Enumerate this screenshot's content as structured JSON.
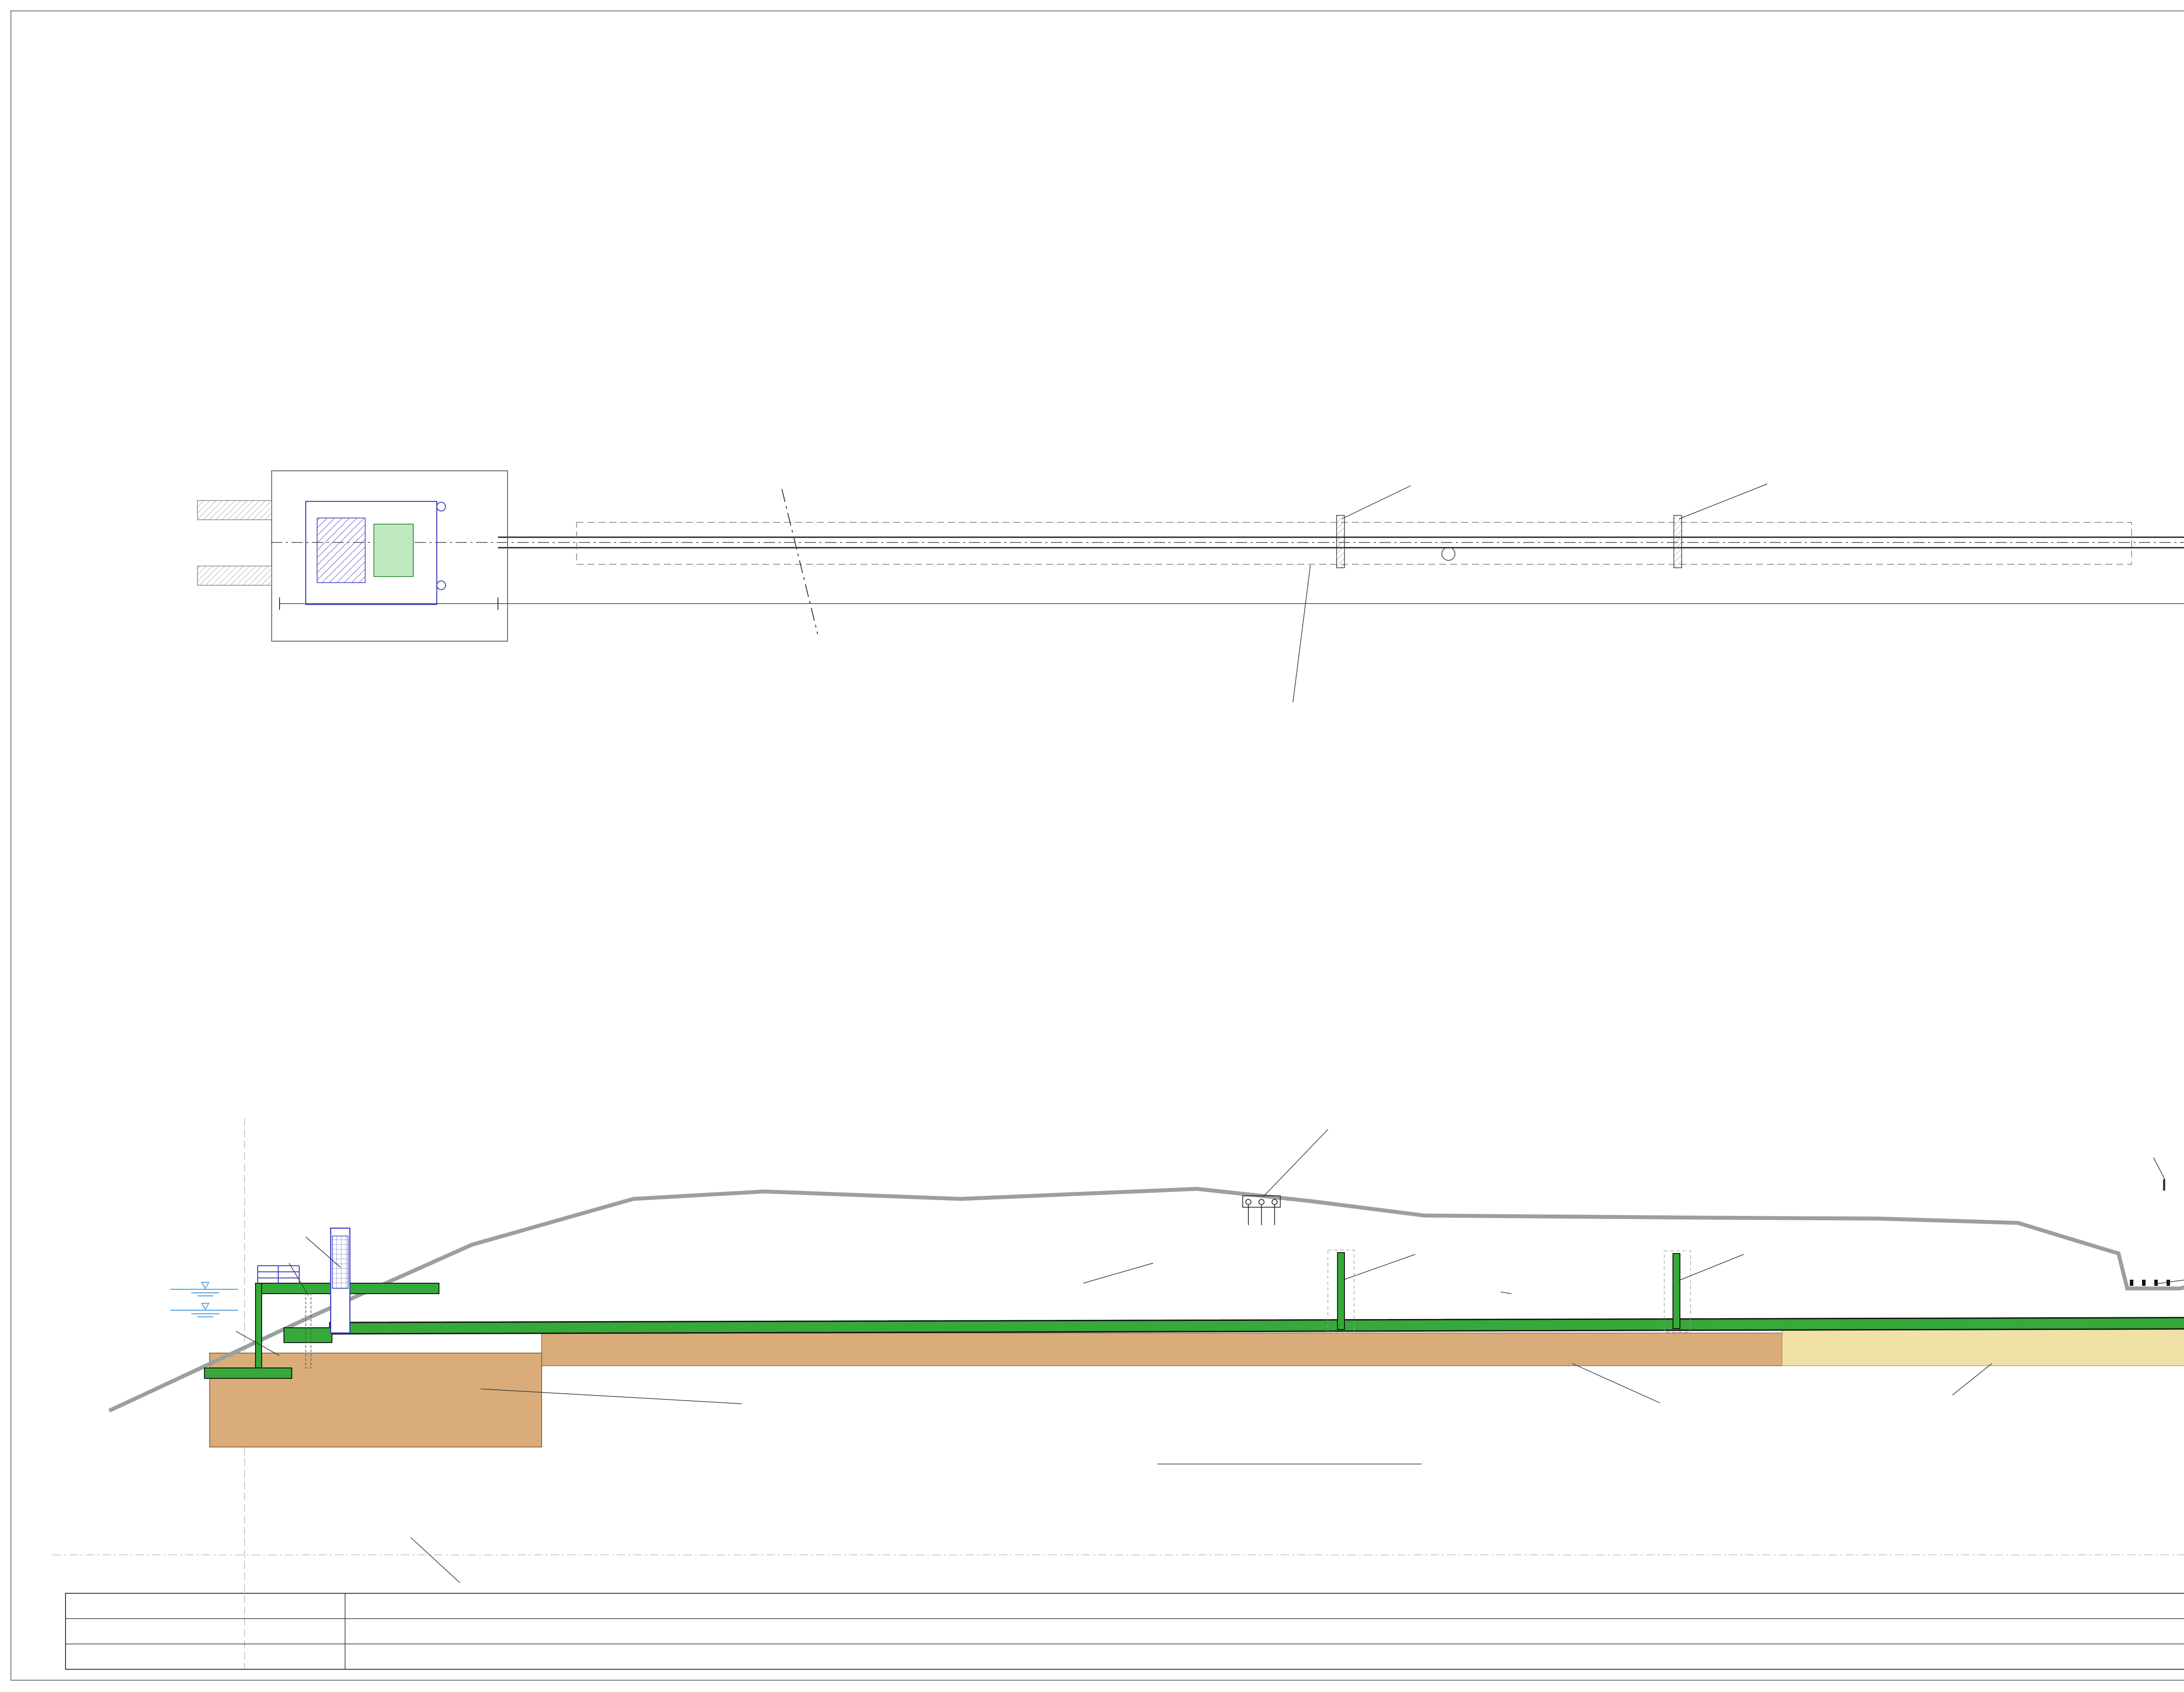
{
  "colors": {
    "pipe_green": "#36a93a",
    "bed_green": "#4fb457",
    "plombe_brown": "#d9ac7a",
    "hgw_pale": "#f0e2a6",
    "spundwand_violet": "#9193e8",
    "structure_blue": "#3a3ac0",
    "terrain_gray": "#9aa0a0",
    "map_water": "#c9e6f4",
    "map_veg": "#b9bdbb",
    "marker_red": "#e31111",
    "strom_red": "#cc3333",
    "wasser_blue": "#4444cc",
    "kanal_tan": "#c08030"
  },
  "draufsicht": {
    "title": "DRAUFSICHT",
    "scale": "1:100",
    "labels": [
      "SCHOTTWAND",
      "SCHOTTWAND",
      "STAHLBETONROHR",
      "DN 1800",
      "STAHLBETONROHR DN 1800   80.51m",
      "BEST. TIEFENVERDICHTUNG",
      "EINLAUFBAUWERK 16.13m",
      "AUSLAUFBAUWERK 9.21m",
      "SWW - BB",
      "VB"
    ],
    "annos": [
      "155.24",
      "368/17",
      "62 6",
      "Stadt Wien (S/S)",
      "Rathaus",
      "A 1082",
      "P1",
      "191.85",
      "P2",
      "156.24",
      "P3",
      "156.74",
      "P5",
      "156.14",
      "14/53",
      "57 26",
      "Stadt Wien (S/S)",
      "Rathaus",
      "A 1082",
      "370/2",
      "62 26",
      "368/19",
      "22 5",
      "368/10",
      "62 6",
      "Gebüsch",
      "Gebüsch",
      "Gebüsch",
      "Gebüsch",
      "Weiche",
      "Weiche",
      "Beton",
      "UN",
      "UN",
      "Panozzalacke",
      "Gleisanlagen",
      "asphaltierter Weg",
      "Steinwurf",
      "U=2.80",
      "U=1.80",
      "U=1.30",
      "U=1.50",
      "U=2.50",
      "U=2.90",
      "U=2.20",
      "U=2.00",
      "Sww"
    ]
  },
  "lageplan": {
    "title": "LAGEPLAN",
    "labels": [
      "PANOZZALACKE",
      "RAFFINERIESTRASSE",
      "PROJ. ÜBERLEITUNGS-",
      "BAUWERK",
      "NEUE DONAU"
    ]
  },
  "querschnitt_rohre": {
    "title": "QUERSCHNITT",
    "scale": "1:50",
    "dims": [
      "25",
      "25",
      "25",
      "25",
      "25",
      "25"
    ],
    "label_left1": "LEITUNGSZONE",
    "label_left2": "MIT SAND VERFÜLLEN 2/4",
    "label1": "7x KSR PE DN 110",
    "label2": "MIT VORSPANN"
  },
  "querschnitt_rohr": {
    "title": "QUERSCHNITT",
    "scale": "1:50",
    "spundwand": "SPUNDWAND",
    "dn": "DN 1800",
    "deg45": "45°",
    "c2025": "C20/25",
    "uwp": "UNTERWASSERPLOMBE",
    "rohraufl1": "ROHRAUFLAGER",
    "rohraufl2": "C20/25",
    "sbr": [
      "STAHLBETONROHR DN 1800",
      "MIT FALZMUFFE UND",
      "INTEGRIERTER DICHTUNG",
      "WANDSTÄRKE MIN. 20cm,",
      "AGGRESSIVITÄTSSTUFE AS1"
    ],
    "absch": [
      "ABSCHALUNG AUS",
      "ELASTISCHER ZWISCHENLAGE"
    ]
  },
  "punkt_table": {
    "headers": [
      "PUNKT Nr.",
      "X",
      "Y"
    ],
    "rows": [
      [
        "R-1",
        "337865.33",
        "11575.27"
      ],
      [
        "R-2",
        "337926.83",
        "11634.68"
      ]
    ]
  },
  "einbauten": {
    "title": "EINBAUTEN:",
    "items": [
      {
        "label": "STROM",
        "letter": "E",
        "color": "#cc3333"
      },
      {
        "label": "WASSER",
        "letter": "W",
        "color": "#4444cc"
      },
      {
        "label": "KANAL",
        "letter": "K",
        "color": "#c08030"
      }
    ]
  },
  "laengsschnitt": {
    "title": "LÄNGSSCHNITT",
    "scale": "1:100",
    "labels": [
      "NEUE DONAU",
      "REVISIONSSCHÜTZ",
      "DAMMBALKENNISCHE",
      "STAT. STAU MAX +154.10",
      "STAT. STAU MIN +153.10",
      "GROBRECHEN",
      "+154.37",
      "+152.10",
      "+150.10",
      "TREPPENWEG",
      "+154.77",
      "RADWEG",
      "ZULEITUNG",
      "E-VERSORGUNG",
      "NEBENFAHRBAHN",
      "RAFFINERIESTRASSE",
      "PARKSTREIFEN",
      "LEITSCHIENE",
      "SCHOTTWAND",
      "SCHOTTWAND",
      "PROJ. KABELSCHUTZROHRE",
      "4x KSR PE DN 110 MIT VORSPANN",
      "PROJ. KABELSCHUTZROHRE",
      "7x KSR PE DN 110 MIT VORSPANN",
      "PROJ. KABELSCHUTZROHRE",
      "5x KSR PE DN 110 MIT VORSPANN",
      "STAHLBETONROHR",
      "DN 1800",
      "0,35% GEFÄLLE",
      "GLEISANLAGE",
      "PANOZZALACKE",
      "GROBRECHEN",
      "HOCHWASSERSCHUTZ",
      "UNTERWASSERPLOMBE",
      "UNTERWASSERPLOMBE",
      "BEST. TIEFENVERDICHTUNG",
      "HGW-KÖRPER",
      "PROJ. MIKROPFÄHLE",
      "lg=14.0m",
      "VE = +140.00",
      "VE = +140.00"
    ]
  },
  "stationierung": {
    "rows": [
      "STATIONIERUNG",
      "BEST. GELÄNDEOBERKANTE",
      "PROJ. BAUWERKE"
    ],
    "stations": [
      "0.00",
      "3.23",
      "16.13",
      "26.13",
      "36.13",
      "46.13",
      "56.13",
      "66.13",
      "76.13",
      "86.13",
      "96.64",
      "105.85"
    ],
    "elevations": [
      "+151.72",
      "+153.95",
      "+154.60",
      "+154.75",
      "+154.20",
      "+153.90",
      "+152.30",
      "+151.45"
    ],
    "spans": [
      {
        "label": "EINLAUFBAUWERK 16.13m"
      },
      {
        "label": "STAHLBETONROHR DN 1800   80.51m"
      },
      {
        "label": "AUSLAUFBAUWERK 9.21m"
      }
    ]
  },
  "titleblock": {
    "stadt": "Stadt",
    "wien": "Wien",
    "dept1": "Wiener",
    "dept2": "Gewässer",
    "projekt_label": "PROJEKT:",
    "project_title": "DOTATION PANOZZALACKE",
    "project_subtitle": "AUSSCHREIBUNGSPROJEKT",
    "planinhalt_label": "PLANINHALT:",
    "plan_title1": "ÜBERLEITUNGSBAUWERK",
    "plan_title2": "ÜBERSICHT UND LÄNGSSCHNITT",
    "dateiname": "DATEINAME: 107601-AS-D-01-B.DWG",
    "rev_headers": {
      "ind": "IND.",
      "datum": "DATUM:",
      "aenderung": "ÄNDERUNG:",
      "gez": "GEZ.:",
      "geprueft": "GEPRÜFT:",
      "freigabe": "FREIGABE:"
    },
    "rev_rows": [
      {
        "ind": "A",
        "datum": "05.09.2022",
        "aenderung": "ERSTAUFLAGE",
        "gez": "DSL",
        "geprueft": "JSR",
        "freigabe": "JSR"
      },
      {
        "ind": "B",
        "datum": "12.10.2022",
        "aenderung": "KABELSCHUTZROHRE",
        "gez": "DSL",
        "geprueft": "JSR",
        "freigabe": "JSR"
      }
    ],
    "pm_label": "PROJEKTMANAGEMENT:",
    "wgm": {
      "w": "W",
      "g": "G",
      "m": "M",
      "sub1": "Wiener",
      "sub2": "Gewässer",
      "sub3": "Management",
      "addr1": "Gesellschaft mbH",
      "addr2": "Heinrich-von-Buol-Gasse 6",
      "addr3": "1210 Wien"
    },
    "planung_label": "PLANUNG:",
    "dc": {
      "logo": "DONAUCONSULT",
      "l1": "DonauConsult Ingenieurbüro GmbH",
      "l2": "Klopstockgasse 34  |  1170 Wien  |  Austria",
      "l3": "T: 0043 1 480 80 10, F: DW 10",
      "l4": "office@donauconsult.at",
      "l5": "www.donauconsult.at"
    },
    "twp_label": "TRAGWERKSPLANUNG:",
    "zt": {
      "b1": "Ziviltechnikerbüro",
      "b2": "Dipl.-Ing. Josef Schelmberger",
      "b3": "Ingenieurkonsulent für Bauwesen",
      "a1": "Lassallestraße 7a / Unit 3 / Top 6",
      "a2": "1020 Wien, Österreich",
      "a3": "Telefon +43-(0)1-330 61 91-0",
      "a4": "E-Mail   zt-buero@schelmberger.at"
    },
    "groesse_label": "GRÖSSE:",
    "groesse": "",
    "datum_label": "DATUM:",
    "datum": "12.10.2022",
    "projektnummer_label": "PROJEKTNUMMER:",
    "projektnummer": "107601",
    "plannummer_label": "PLANNUMMER:",
    "plannummer": "AS-D-01-B"
  }
}
